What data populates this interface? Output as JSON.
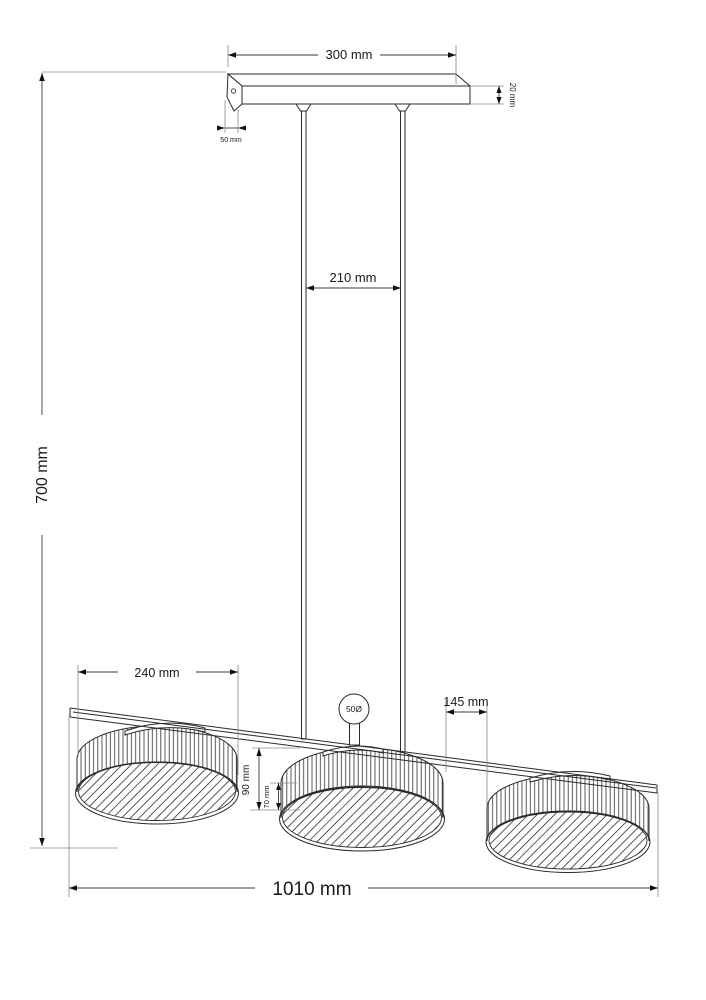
{
  "drawing": {
    "title": "Three-shade pendant lamp dimensional drawing",
    "unit": "mm",
    "canopy": {
      "width_label": "300 mm",
      "thickness_label": "20 mm",
      "depth_label": "50 mm"
    },
    "suspension": {
      "rod_spacing_label": "210 mm",
      "ball_joint_label": "50Ø"
    },
    "shades": {
      "count": 3,
      "diameter_label": "240 mm",
      "gap_label": "145 mm",
      "overall_height_label": "90 mm",
      "body_height_label": "70 mm"
    },
    "overall": {
      "height_label": "700 mm",
      "length_label": "1010 mm"
    },
    "colors": {
      "line": "#2a2a2a",
      "dimension": "#3a3a3a",
      "extension": "#8a8a8a",
      "background": "#ffffff"
    }
  }
}
